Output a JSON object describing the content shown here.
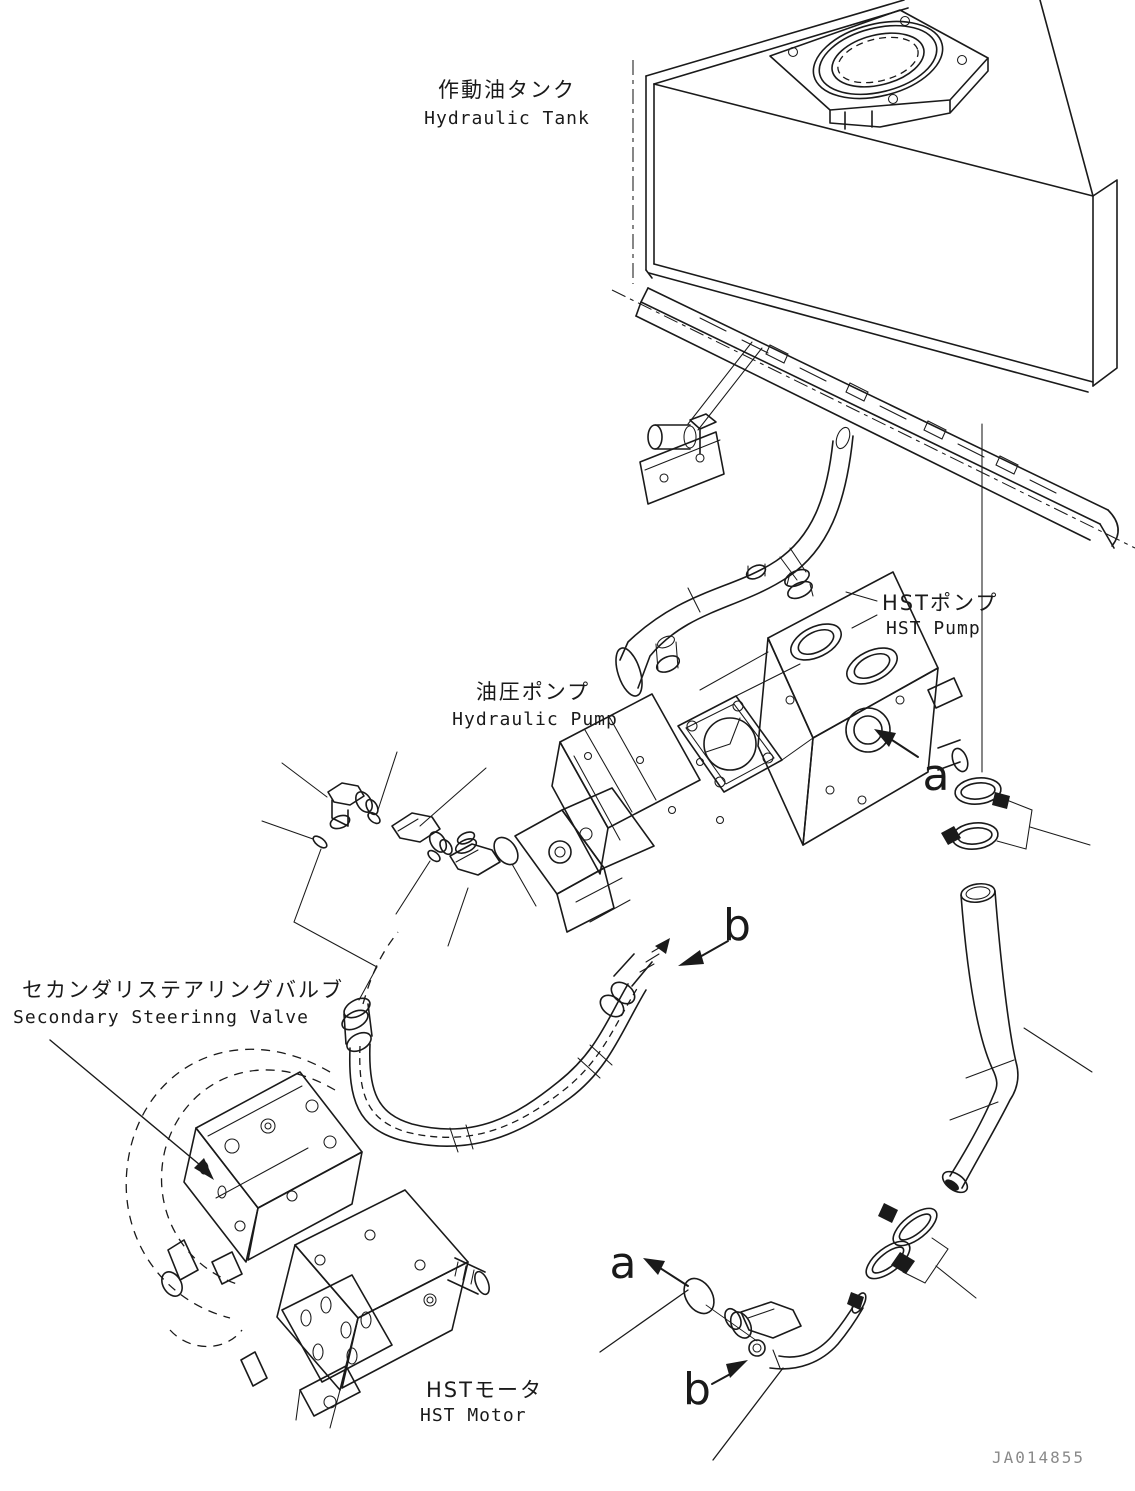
{
  "figure": {
    "type": "parts-diagram",
    "part_number": "JA014855",
    "background_color": "#ffffff",
    "line_color": "#1a1a1a",
    "part_number_color": "#8a8a8a"
  },
  "labels": {
    "hydraulic_tank": {
      "ja": "作動油タンク",
      "en": "Hydraulic Tank"
    },
    "hst_pump": {
      "ja": "HSTポンプ",
      "en": "HST Pump"
    },
    "hydraulic_pump": {
      "ja": "油圧ポンプ",
      "en": "Hydraulic Pump"
    },
    "secondary_steering_valve": {
      "ja": "セカンダリステアリングバルブ",
      "en": "Secondary Steerinng Valve"
    },
    "hst_motor": {
      "ja": "HSTモータ",
      "en": "HST Motor"
    }
  },
  "callouts": {
    "a_upper": "a",
    "b_upper": "b",
    "a_lower": "a",
    "b_lower": "b"
  }
}
